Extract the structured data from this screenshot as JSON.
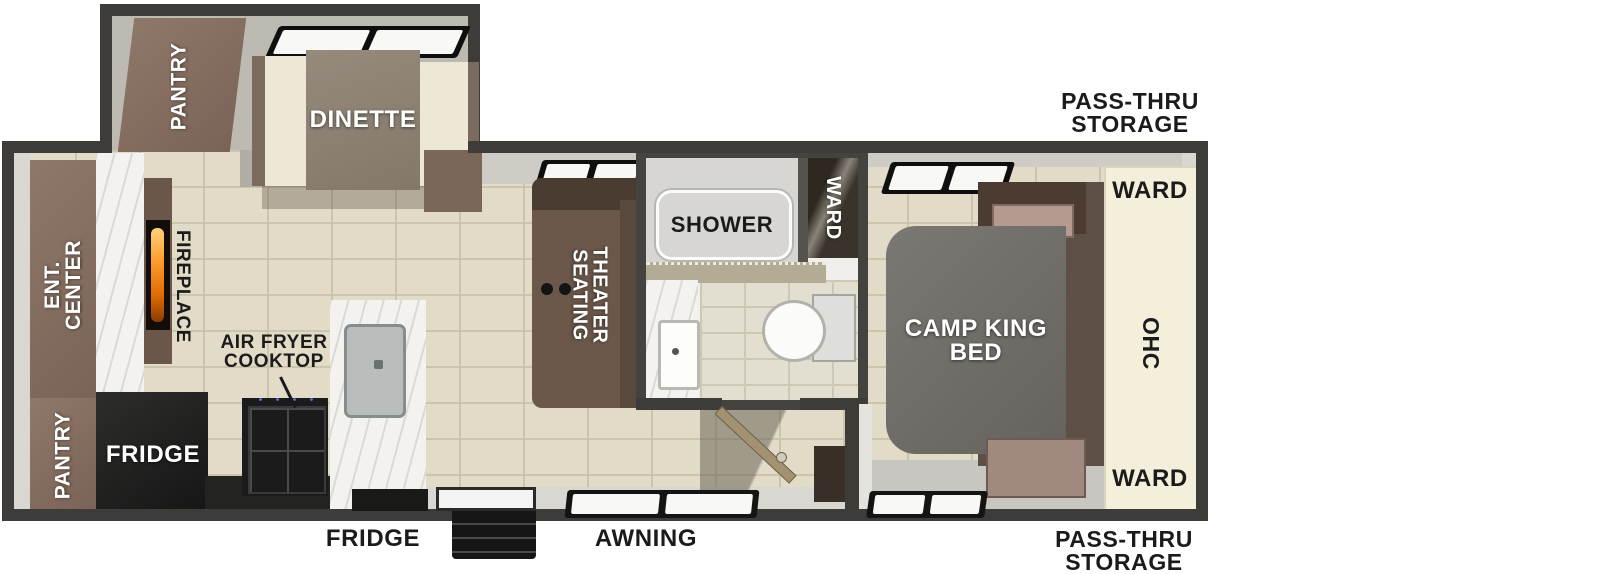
{
  "floorplan": {
    "exterior_labels": {
      "pass_thru_top": "PASS-THRU\nSTORAGE",
      "pass_thru_bottom": "PASS-THRU\nSTORAGE",
      "fridge_vent": "FRIDGE",
      "awning": "AWNING"
    },
    "slide_out": {
      "pantry": "PANTRY",
      "dinette": "DINETTE"
    },
    "living_kitchen": {
      "ent_center": "ENT. CENTER",
      "fireplace": "FIREPLACE",
      "pantry": "PANTRY",
      "fridge": "FRIDGE",
      "air_fryer_cooktop": "AIR FRYER\nCOOKTOP",
      "theater_seating": "THEATER\nSEATING"
    },
    "bathroom": {
      "shower": "SHOWER",
      "ward": "WARD"
    },
    "bedroom": {
      "bed": "CAMP KING\nBED",
      "ward_top": "WARD",
      "ohc": "OHC",
      "ward_bottom": "WARD"
    },
    "colors": {
      "wall_dark": "#3e3c38",
      "wall_lining": "#d9d7d2",
      "floor_tile": "#e1dbc7",
      "cabinet_brown": "#8b7365",
      "bench_cream": "#ece7d6",
      "bed_gray": "#6f6c68",
      "wardrobe_cream": "#f4efdb",
      "label_black": "#1b1b1b",
      "flame_orange": "#ff9d2e",
      "marble_white": "#f3f2ef",
      "appliance_black": "#1c1c1c"
    }
  }
}
